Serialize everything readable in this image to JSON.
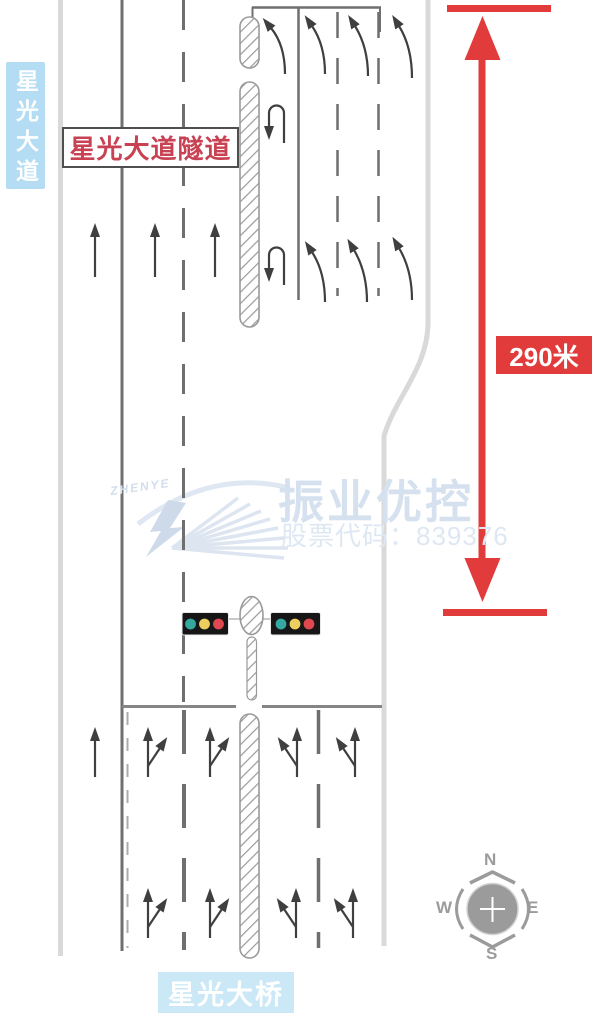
{
  "diagram": {
    "road_label_left": "星光大道",
    "tunnel_label": "星光大道隧道",
    "distance_label": "290米",
    "bridge_label": "星光大桥",
    "distance_meters": 290
  },
  "watermark": {
    "logo_text": "ZHENYE",
    "brand": "振业优控",
    "stock_code": "股票代码：839376"
  },
  "compass": {
    "n": "N",
    "e": "E",
    "s": "S",
    "w": "W"
  },
  "traffic_signals": {
    "heads": 2,
    "light_order": [
      "green",
      "yellow",
      "red"
    ]
  },
  "lanes": {
    "south_approach_arrows": [
      "straight",
      "straight-right",
      "straight-right",
      "straight-left",
      "straight-left"
    ],
    "north_section_arrows": [
      "merge-left",
      "merge-left",
      "merge-left",
      "merge-left"
    ],
    "median_uturn_arrows": 2,
    "mid_section_straight_arrows": 3
  },
  "colors": {
    "road_edge": "#d9d9d9",
    "lane_line": "#6f6f6f",
    "hatch_gray": "#9a9a9a",
    "measure_red": "#e23b3b",
    "label_blue_bg": "#b4dcf2",
    "bridge_blue_bg": "#cbe8f7",
    "tunnel_text_red": "#c84253",
    "watermark_blue": "#d6e1ef",
    "signal_green": "#33a7a0",
    "signal_yellow": "#eccf5e",
    "signal_red": "#e0484f",
    "compass_gray": "#9b9b9b"
  }
}
